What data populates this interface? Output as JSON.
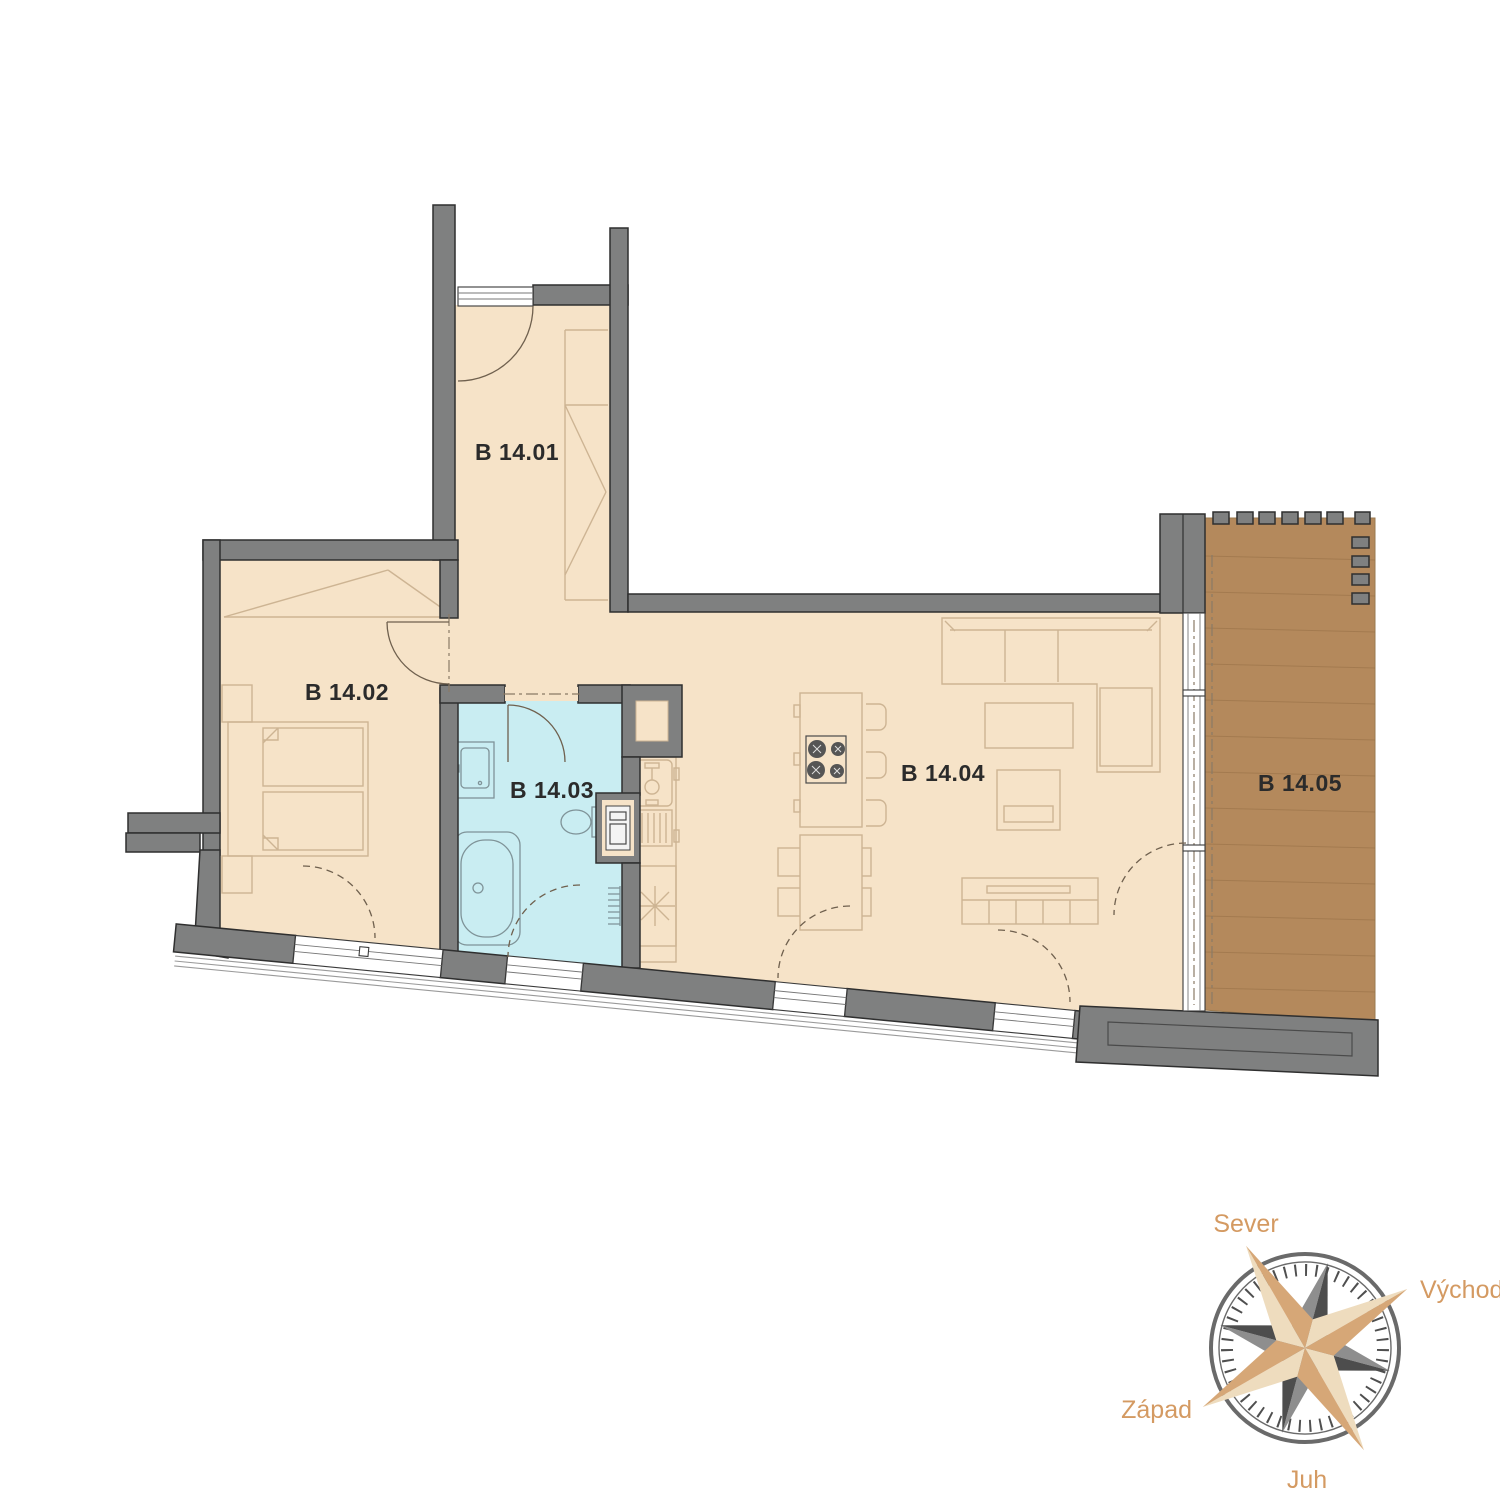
{
  "plan": {
    "rooms": [
      {
        "code": "B 14.01"
      },
      {
        "code": "B 14.02"
      },
      {
        "code": "B 14.03"
      },
      {
        "code": "B 14.04"
      },
      {
        "code": "B 14.05"
      }
    ]
  },
  "compass": {
    "north": "Sever",
    "east": "Východ",
    "south": "Juh",
    "west": "Západ"
  },
  "colors": {
    "background": "#ffffff",
    "floor": "#f6e3c8",
    "bathroom": "#c9edf2",
    "terrace": "#b4895c",
    "wall": "#7f8080",
    "wall_outline": "#2f2f2f",
    "furniture_line": "#cdb493",
    "fixture_line": "#7f9398",
    "label_text": "#2b2b2b",
    "compass_text": "#d49a62",
    "compass_tan_light": "#eedcbe",
    "compass_tan_dark": "#d6a777",
    "compass_gray_light": "#8e8e8e",
    "compass_gray_dark": "#4d4d4d"
  }
}
